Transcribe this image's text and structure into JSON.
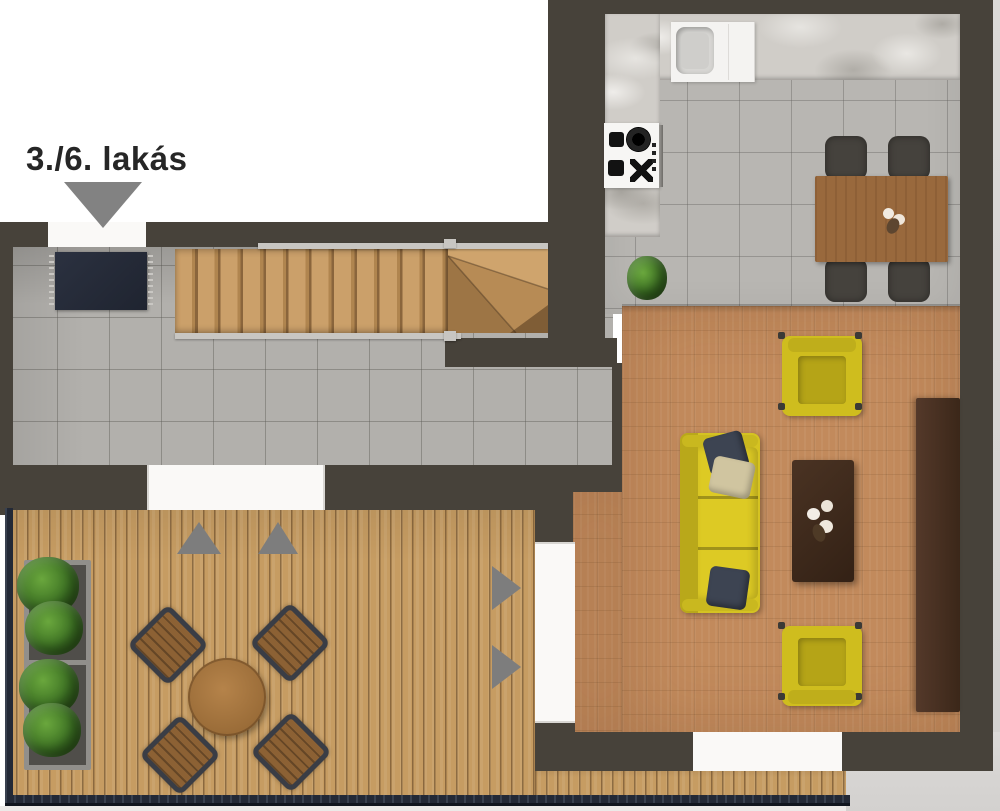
{
  "floorplan": {
    "title": "3./6. lakás",
    "colors": {
      "wall": "#47423a",
      "hall_tile": "#b2b0ac",
      "kitchen_tile": "#b8b6b2",
      "parquet_floor": "#c28a5c",
      "terrace_deck": "#c69c62",
      "stairs_wood": "#c89c65",
      "marble_counter": "#d0cdc8",
      "sofa_yellow": "#d5c322",
      "coffee_table": "#3f2b1e",
      "sideboard": "#4a3122",
      "dining_table": "#99693d",
      "dining_chair": "#45423d",
      "terrace_chair_frame": "#3a3d45",
      "terrace_table": "#a87a42",
      "doormat": "#262c38",
      "railing": "#232936",
      "direction_arrow": "#7d7d7d",
      "plant_green": "#3f7c2b",
      "door_opening": "#faf9f7",
      "outside": "#d8d6d3",
      "label_text": "#262626"
    }
  }
}
